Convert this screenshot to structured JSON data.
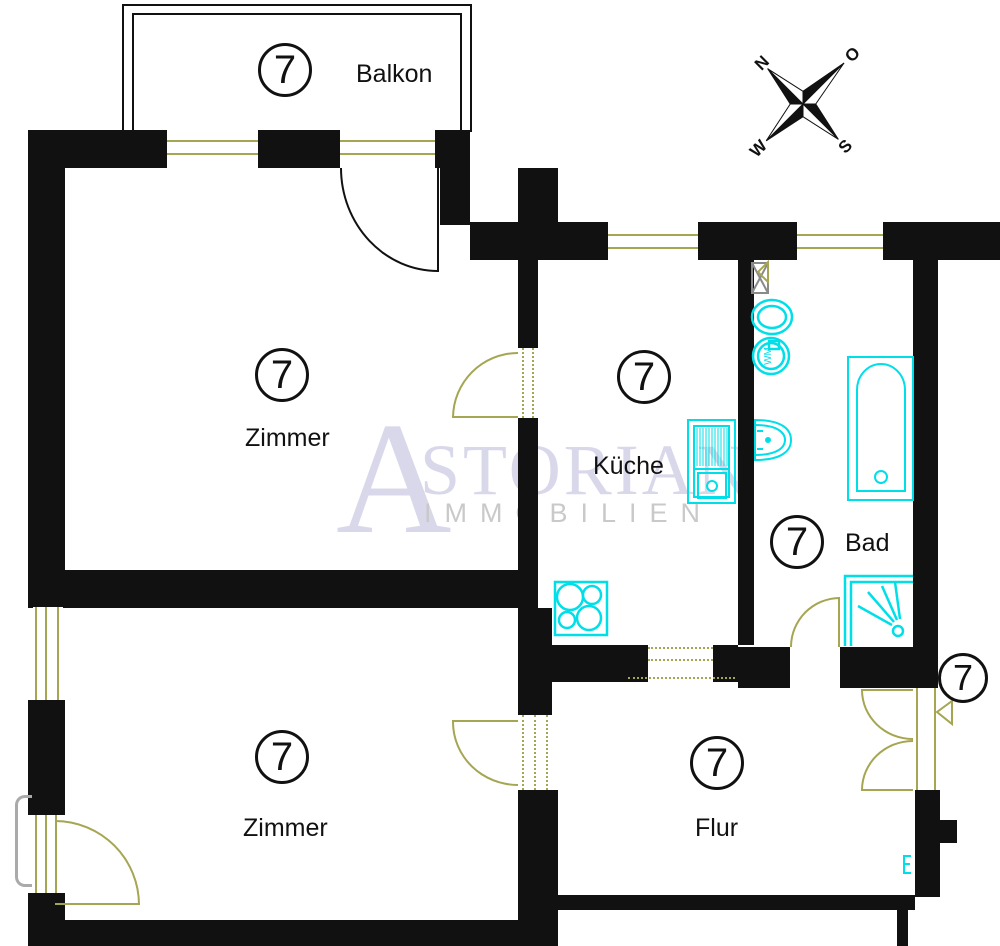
{
  "unit_number": "7",
  "rooms": {
    "balkon": {
      "number": "7",
      "label": "Balkon"
    },
    "zimmer1": {
      "number": "7",
      "label": "Zimmer"
    },
    "kueche": {
      "number": "7",
      "label": "Küche"
    },
    "bad": {
      "number": "7",
      "label": "Bad"
    },
    "zimmer2": {
      "number": "7",
      "label": "Zimmer"
    },
    "flur": {
      "number": "7",
      "label": "Flur"
    },
    "entrance": {
      "number": "7"
    }
  },
  "compass": {
    "north": "N",
    "east": "O",
    "south": "S",
    "west": "W"
  },
  "watermark": {
    "initial": "A",
    "rest": "STORIAN",
    "subtitle": "IMMOBILIEN"
  },
  "fixtures": {
    "washing_machine_label": "WM"
  },
  "colors": {
    "wall": "#111111",
    "joinery": "#a5a552",
    "fixture": "#00dfe8",
    "watermark_text": "#d8d8ea",
    "watermark_subtitle": "#c9c9c9",
    "outside_rail": "#aaaaaa",
    "vent": "#8a8a8a"
  }
}
